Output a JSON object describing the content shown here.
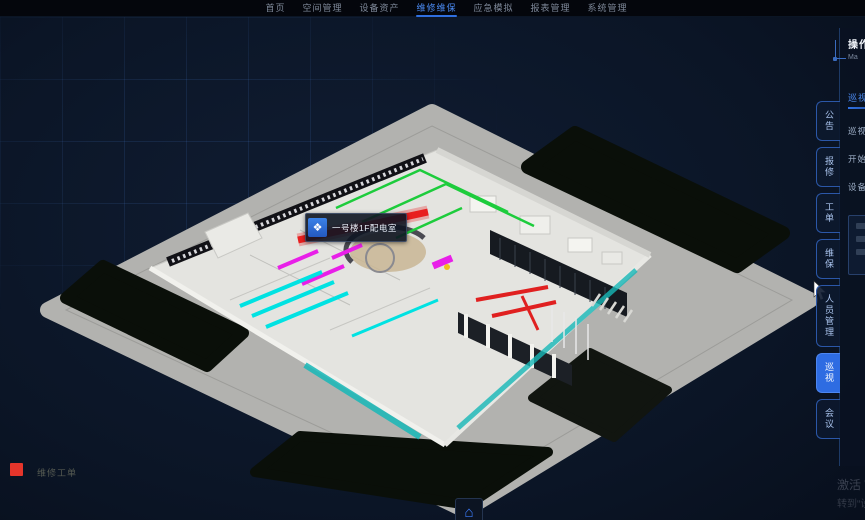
{
  "nav": {
    "items": [
      {
        "label": "首页",
        "active": false
      },
      {
        "label": "空间管理",
        "active": false
      },
      {
        "label": "设备资产",
        "active": false
      },
      {
        "label": "维修维保",
        "active": true
      },
      {
        "label": "应急模拟",
        "active": false
      },
      {
        "label": "报表管理",
        "active": false
      },
      {
        "label": "系统管理",
        "active": false
      }
    ]
  },
  "scene": {
    "tooltip": {
      "icon_glyph": "❖",
      "text": "一号楼1F配电室"
    },
    "legend": {
      "swatch_color": "#e5352b",
      "label": "维修工单"
    },
    "home_button_glyph": "⌂"
  },
  "right_tabs": {
    "items": [
      {
        "label": "公告",
        "active": false
      },
      {
        "label": "报修",
        "active": false
      },
      {
        "label": "工单",
        "active": false
      },
      {
        "label": "维保",
        "active": false
      },
      {
        "label": "人员管理",
        "active": false
      },
      {
        "label": "巡视",
        "active": true
      },
      {
        "label": "会议",
        "active": false
      }
    ]
  },
  "right_panel": {
    "title": "操作",
    "subtitle": "Ma",
    "section_title": "巡视路线",
    "fields": [
      {
        "label": "巡视范围"
      },
      {
        "label": "开始时间"
      },
      {
        "label": "设备分类"
      }
    ]
  },
  "watermark": {
    "line1": "激活 Windows",
    "line2": "转到“设置”以激活 Windows。"
  },
  "colors": {
    "accent": "#2f6fe0",
    "tab_active": "#2e6ce2",
    "pipe_green": "#1dcc3c",
    "duct_red": "#e81f1f",
    "equip_magenta": "#e81fe8",
    "pipe_cyan": "#00e2e2",
    "legend_red": "#e5352b"
  }
}
